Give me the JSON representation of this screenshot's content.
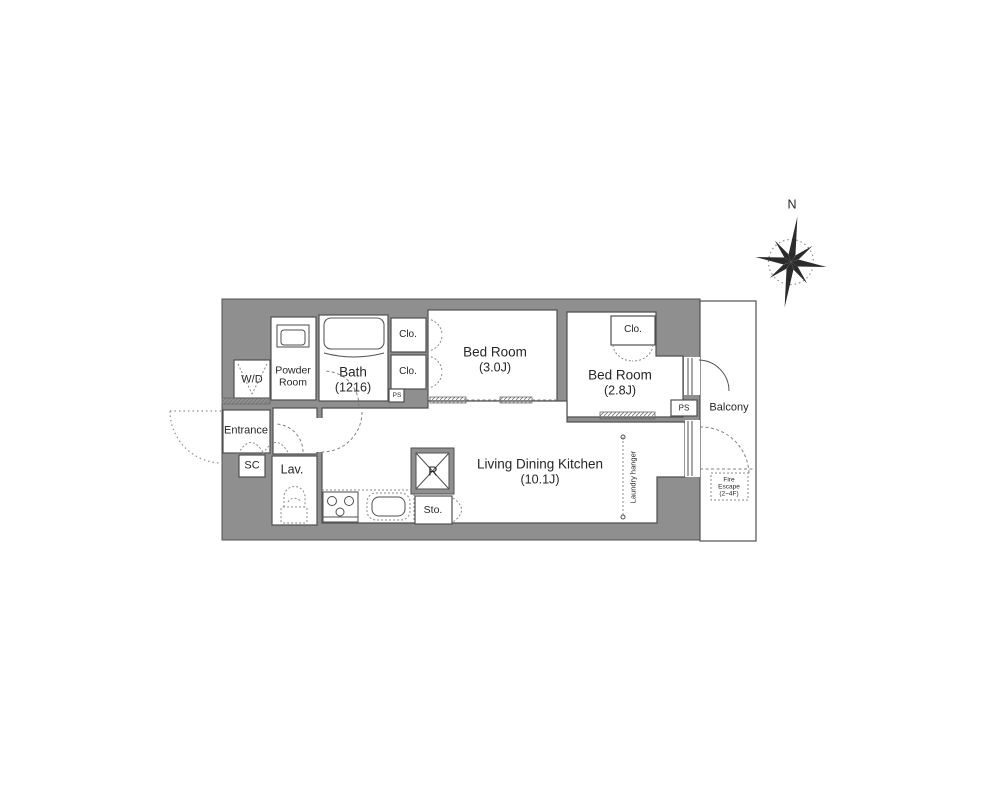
{
  "colors": {
    "wall": "#8f8f8f",
    "line": "#4f4f4f",
    "text": "#262626",
    "bg": "#ffffff"
  },
  "compass": {
    "north": "N"
  },
  "rooms": {
    "wd": "W/D",
    "powder1": "Powder",
    "powder2": "Room",
    "bath1": "Bath",
    "bath2": "(1216)",
    "clo_a": "Clo.",
    "clo_b": "Clo.",
    "clo_c": "Clo.",
    "bed1_1": "Bed Room",
    "bed1_2": "(3.0J)",
    "bed2_1": "Bed Room",
    "bed2_2": "(2.8J)",
    "entrance": "Entrance",
    "sc": "SC",
    "lav": "Lav.",
    "ldk1": "Living Dining Kitchen",
    "ldk2": "(10.1J)",
    "fridge": "R",
    "sto": "Sto.",
    "ps_a": "PS",
    "ps_b": "PS",
    "balcony": "Balcony",
    "laundry": "Laundry hanger",
    "fire1": "Fire",
    "fire2": "Escape",
    "fire3": "(2~4F)"
  }
}
